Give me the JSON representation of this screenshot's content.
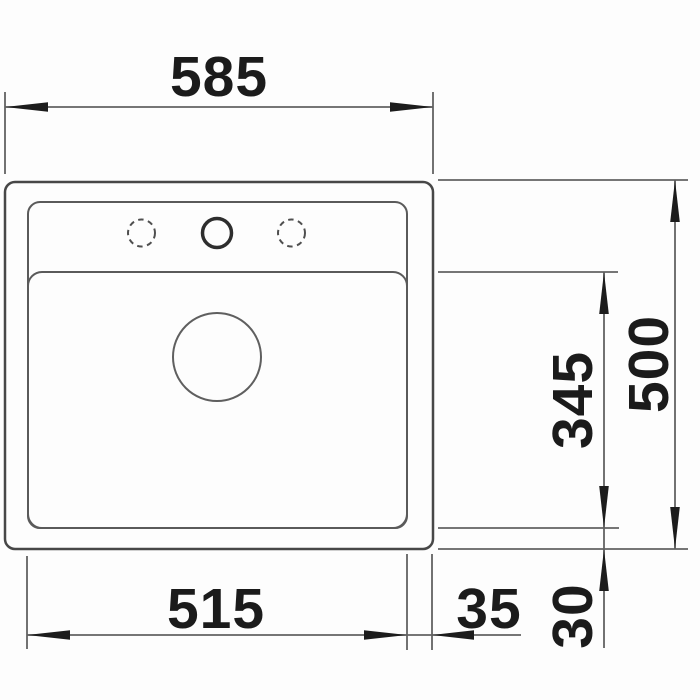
{
  "drawing": {
    "type": "sink-installation-dimension-drawing",
    "dims": {
      "overall_width": "585",
      "basin_width": "515",
      "right_edge_offset": "35",
      "overall_depth": "500",
      "basin_depth": "345",
      "bottom_edge_offset": "30"
    },
    "features": {
      "tap_hole_left": "dashed-circle-optional-tap-hole",
      "tap_hole_center": "solid-circle-tap-hole",
      "tap_hole_right": "dashed-circle-optional-tap-hole",
      "drain": "drain-circle"
    },
    "colors": {
      "background": "#fdfdfd",
      "object_outline": "#474747",
      "object_inner_lines": "#5a5a5a",
      "dimension_lines": "#636363",
      "text_and_arrows": "#1b1b1b"
    }
  }
}
